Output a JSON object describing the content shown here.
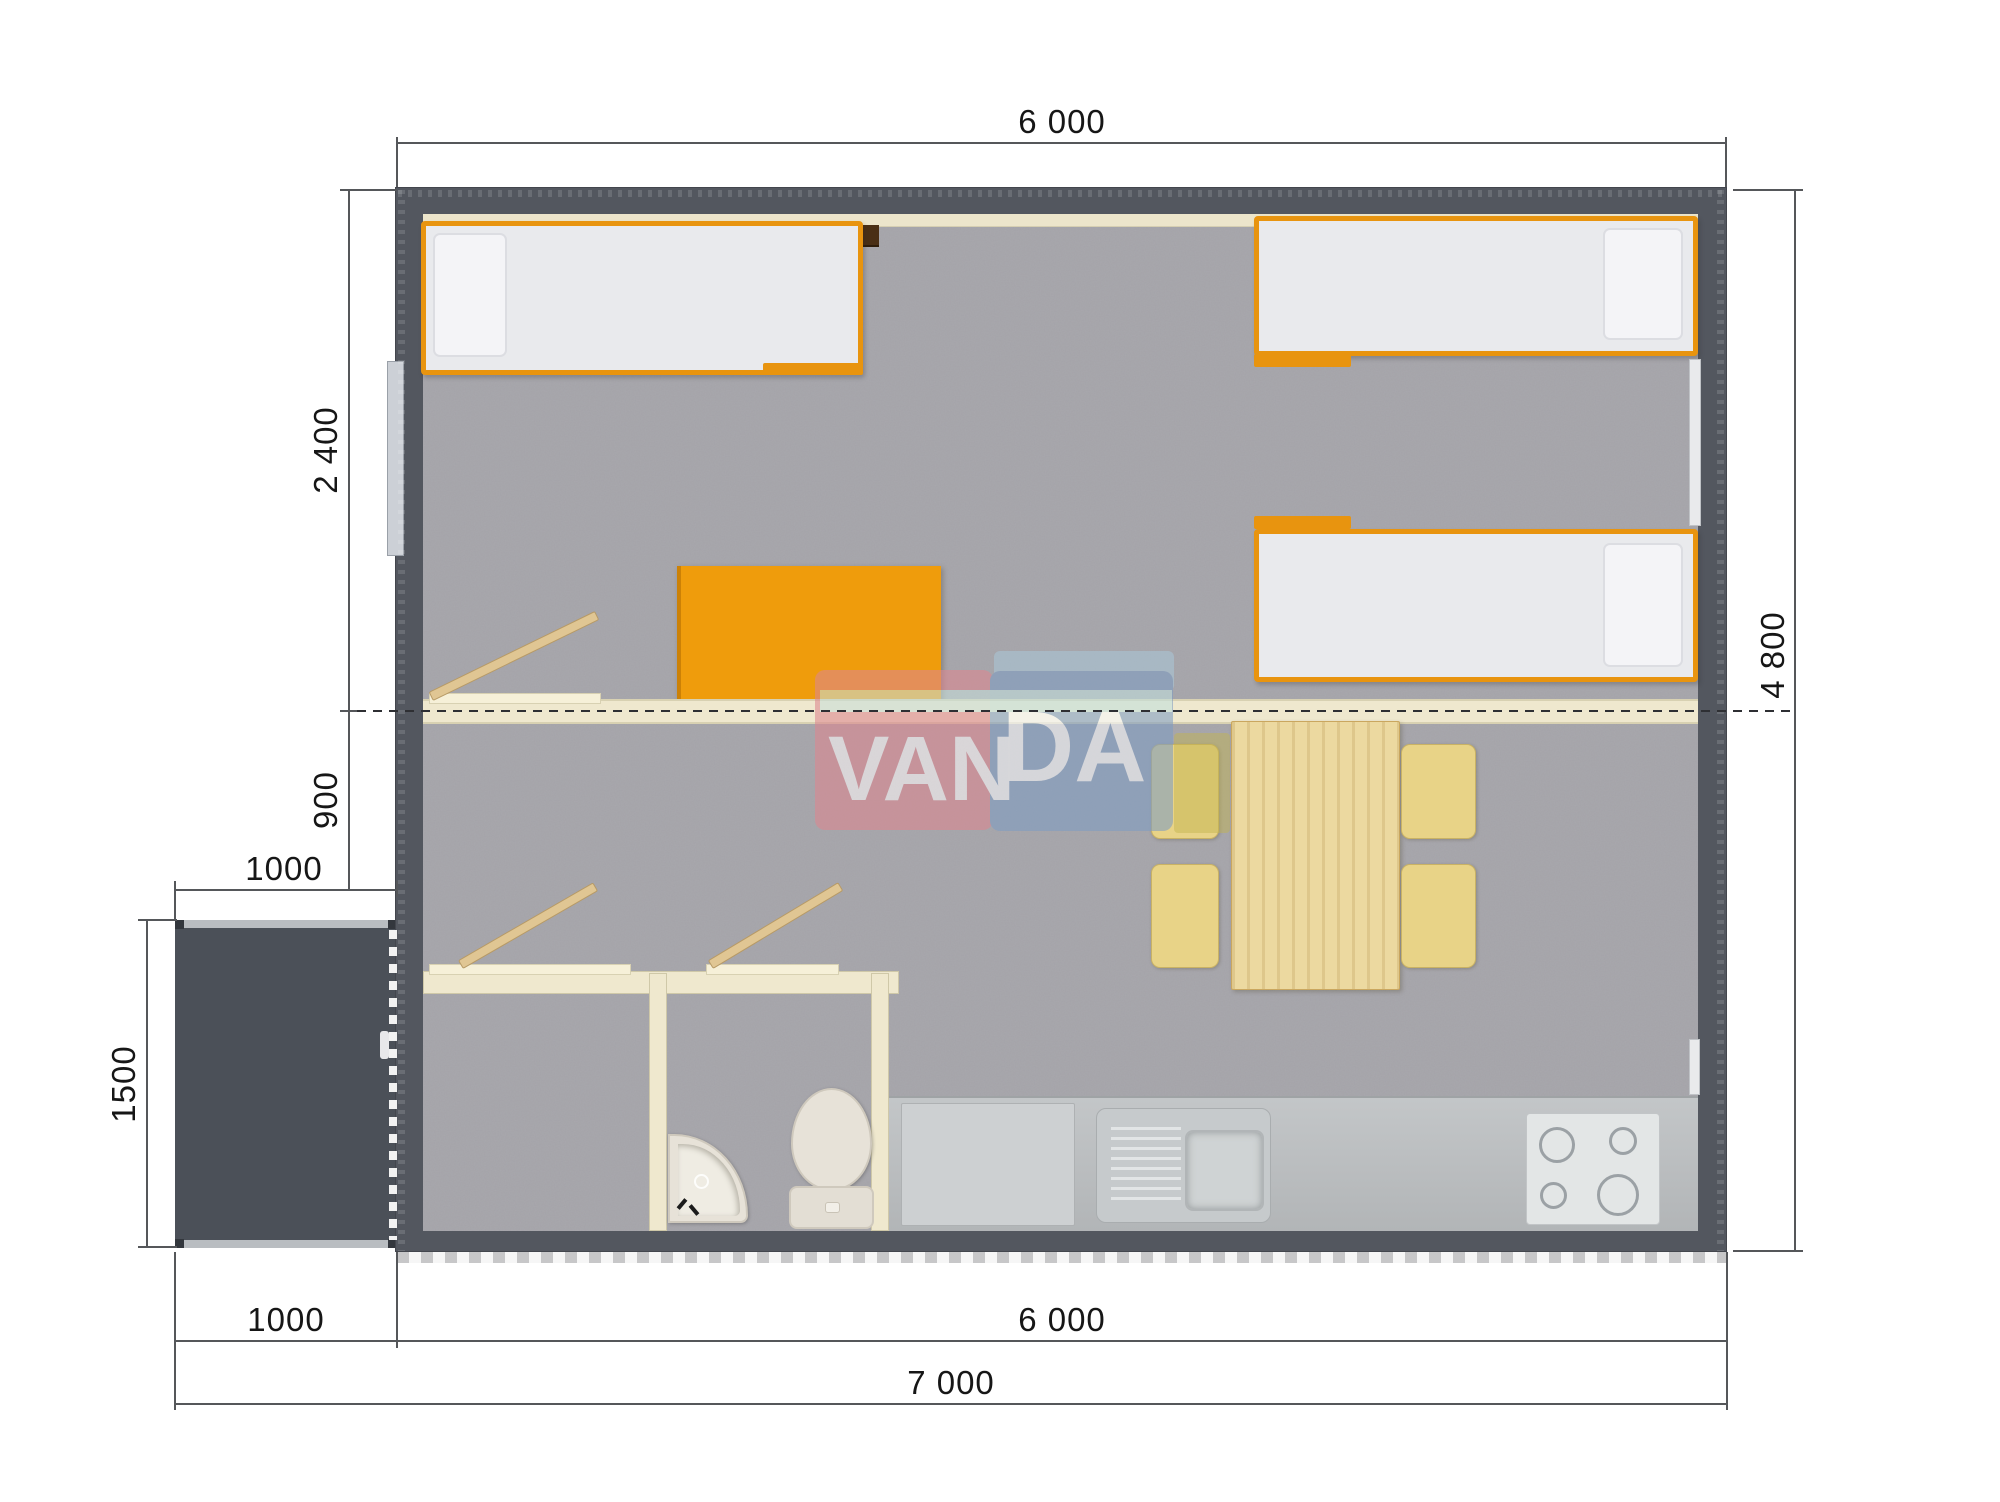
{
  "plan": {
    "watermark": {
      "left_text": "VAN",
      "right_text": "DA"
    },
    "dimensions": {
      "top_width": "6 000",
      "bedroom_depth": "2 400",
      "partition_offset": "900",
      "porch_width_top": "1000",
      "porch_depth": "1500",
      "house_depth": "4 800",
      "porch_width_bottom": "1000",
      "house_width_bottom": "6 000",
      "total_width": "7 000"
    },
    "colors": {
      "exterior_wall": "#53575f",
      "interior_wall": "#efe8ce",
      "floor_carpet": "#a9a8ad",
      "accent_orange": "#e8940f",
      "wood_light": "#e6cf97",
      "kitchen_counter": "#bcbfc1",
      "watermark_pink": "#dd8790",
      "watermark_blue": "#7f9dc3"
    }
  }
}
